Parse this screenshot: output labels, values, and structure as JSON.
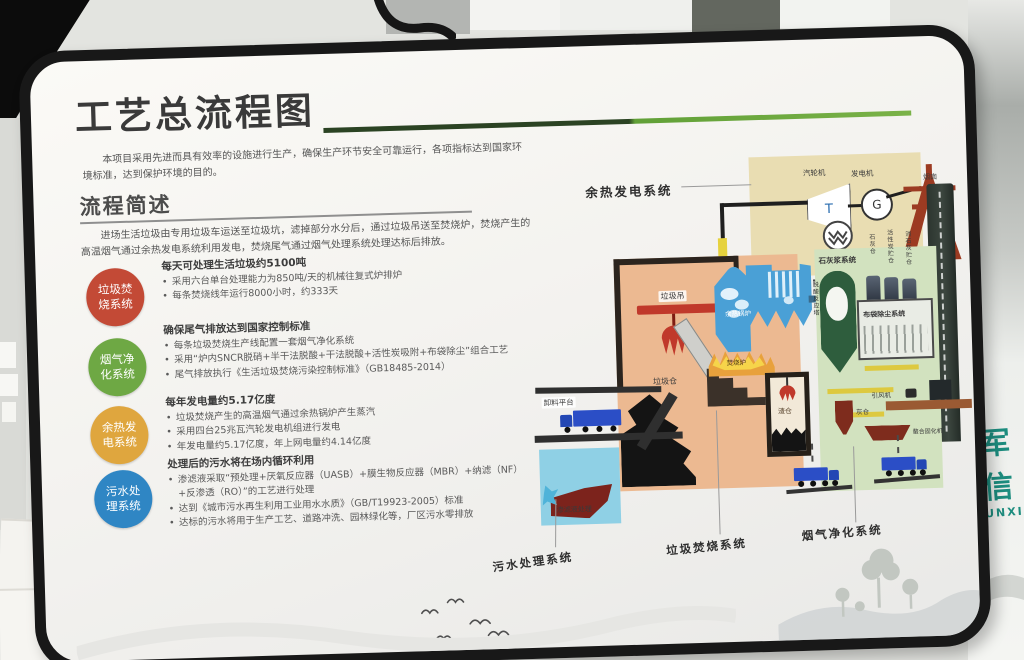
{
  "bg": {
    "sign_line1": "军信",
    "sign_line2": "UNXI"
  },
  "board": {
    "title": "工艺总流程图",
    "intro": "本项目采用先进而具有效率的设施进行生产，确保生产环节安全可靠运行，各项指标达到国家环境标准，达到保护环境的目的。",
    "section": {
      "heading": "流程简述",
      "body": "进场生活垃圾由专用垃圾车运送至垃圾坑，滤掉部分水分后，通过垃圾吊送至焚烧炉，焚烧产生的高温烟气通过余热发电系统利用发电，焚烧尾气通过烟气处理系统处理达标后排放。"
    },
    "systems": [
      {
        "badge": "垃圾焚\n烧系统",
        "color": "#c34a36",
        "heading": "每天可处理生活垃圾约5100吨",
        "bullets": [
          "采用六台单台处理能力为850吨/天的机械往复式炉排炉",
          "每条焚烧线年运行8000小时，约333天"
        ]
      },
      {
        "badge": "烟气净\n化系统",
        "color": "#6ea844",
        "heading": "确保尾气排放达到国家控制标准",
        "bullets": [
          "每条垃圾焚烧生产线配置一套烟气净化系统",
          "采用“炉内SNCR脱硝+半干法脱酸+干法脱酸+活性炭吸附+布袋除尘”组合工艺",
          "尾气排放执行《生活垃圾焚烧污染控制标准》（GB18485-2014）"
        ]
      },
      {
        "badge": "余热发\n电系统",
        "color": "#dfa63e",
        "heading": "每年发电量约5.17亿度",
        "bullets": [
          "垃圾焚烧产生的高温烟气通过余热锅炉产生蒸汽",
          "采用四台25兆瓦汽轮发电机组进行发电",
          "年发电量约5.17亿度，年上网电量约4.14亿度"
        ]
      },
      {
        "badge": "污水处\n理系统",
        "color": "#2f86c4",
        "heading": "处理后的污水将在场内循环利用",
        "bullets": [
          "渗滤液采取“预处理+厌氧反应器（UASB）+膜生物反应器（MBR）+纳滤（NF）+反渗透（RO）”的工艺进行处理",
          "达到《城市污水再生利用工业用水水质》（GB/T19923-2005）标准",
          "达标的污水将用于生产工艺、道路冲洗、园林绿化等，厂区污水零排放"
        ]
      }
    ],
    "diagram": {
      "labels": {
        "power_system": "余热发电系统",
        "turbine": "汽轮机",
        "generator": "发电机",
        "turbine_symbol": "T",
        "generator_symbol": "G",
        "chimney": "烟囱",
        "crane": "垃圾吊",
        "hopper": "料斗",
        "bunker": "垃圾仓",
        "platform": "卸料平台",
        "boiler": "余热锅炉",
        "incinerator": "焚烧炉",
        "slag": "渣仓",
        "lime_slurry": "石灰浆系统",
        "silo1": "石灰仓",
        "silo2": "活性炭贮仓",
        "silo3": "消石灰贮仓",
        "tower": "脱酸反应塔",
        "bag_filter": "布袋除尘系统",
        "fan": "引风机",
        "ash_silo": "灰仓",
        "solidifier": "螯合固化机",
        "leachate": "渗滤液处理",
        "sys_sewage": "污水处理系统",
        "sys_incineration": "垃圾焚烧系统",
        "sys_fluegas": "烟气净化系统"
      }
    }
  }
}
